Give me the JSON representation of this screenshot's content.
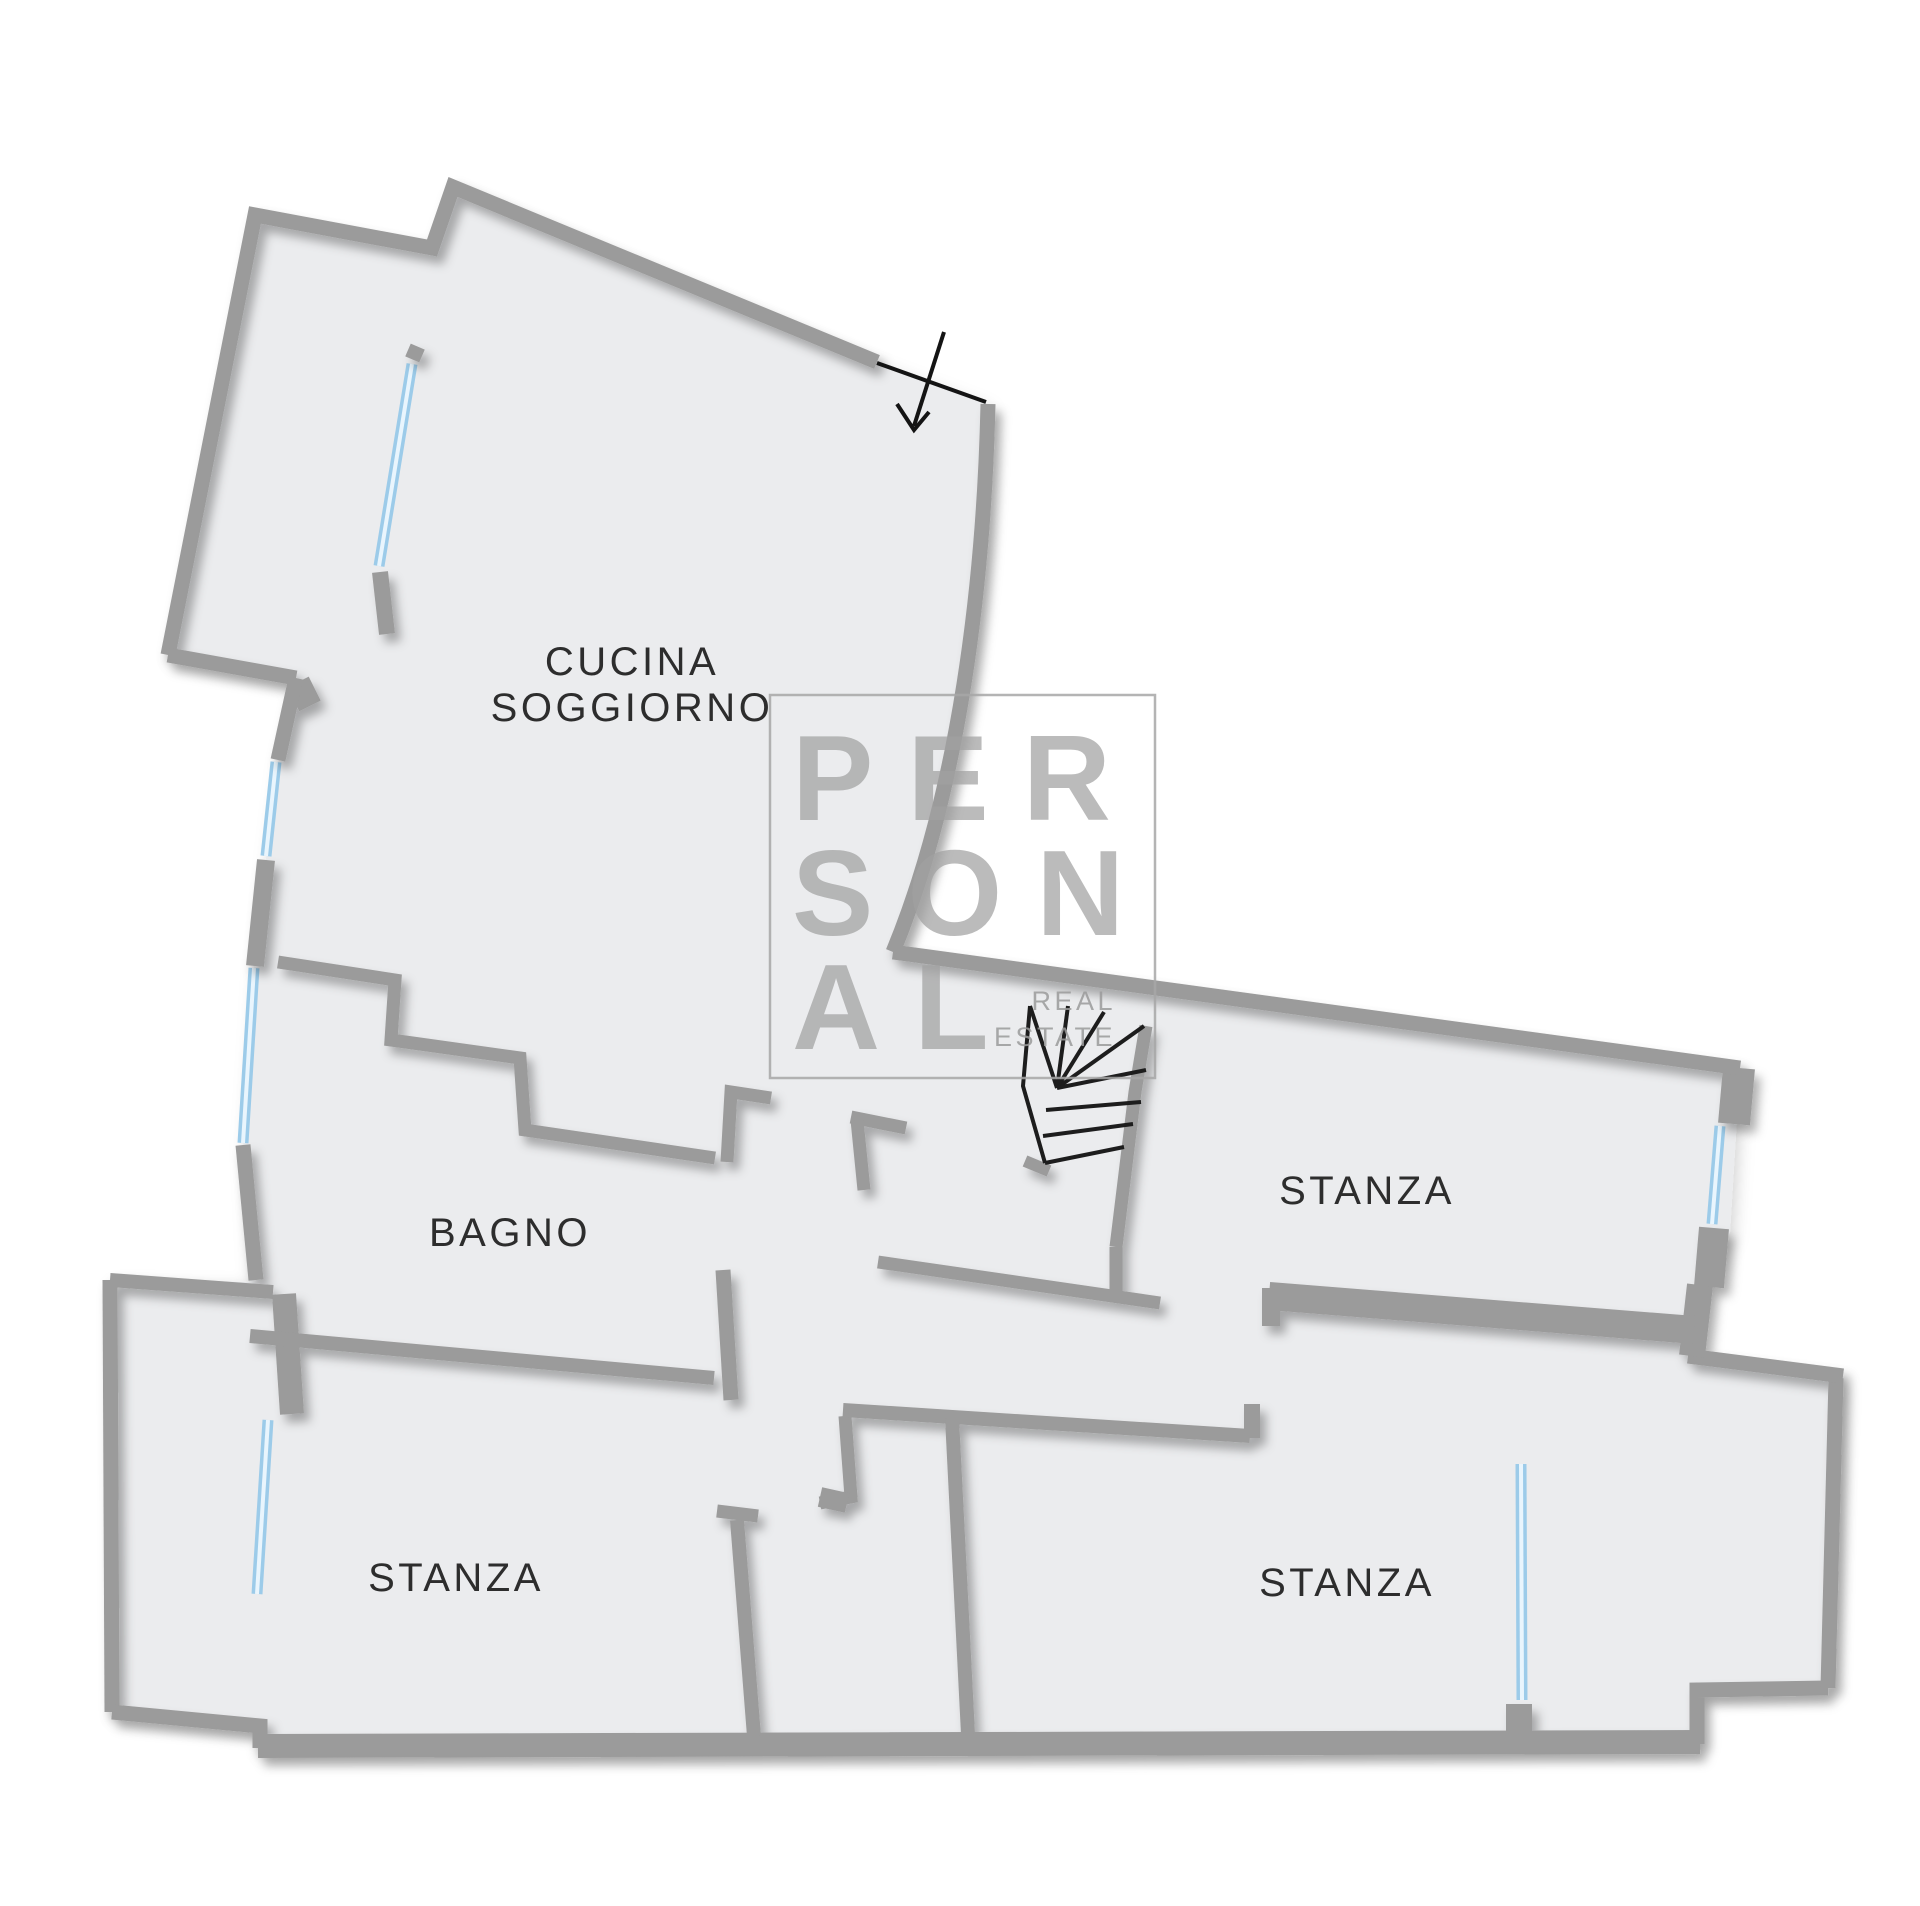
{
  "plan": {
    "title": "floor-plan",
    "rooms": {
      "kitchen_living": {
        "label_line1": "CUCINA",
        "label_line2": "SOGGIORNO"
      },
      "bathroom": {
        "label": "BAGNO"
      },
      "bedroom_right": {
        "label": "STANZA"
      },
      "bedroom_bottom_left": {
        "label": "STANZA"
      },
      "bedroom_bottom_right": {
        "label": "STANZA"
      }
    }
  },
  "watermark": {
    "row1": "PER",
    "row2": "SON",
    "row3": "AL",
    "tag_line1": "REAL",
    "tag_line2": "ESTATE"
  },
  "colors": {
    "floor": "#ebecee",
    "wall": "#9b9b9b",
    "window": "#9ccbe9",
    "window_highlight": "#e9f5fd",
    "stairs": "#1d1d1d",
    "door": "#141414",
    "label": "#2d2d2d",
    "watermark_text": "#a1a1a1",
    "watermark_border": "#a7a7a7"
  }
}
